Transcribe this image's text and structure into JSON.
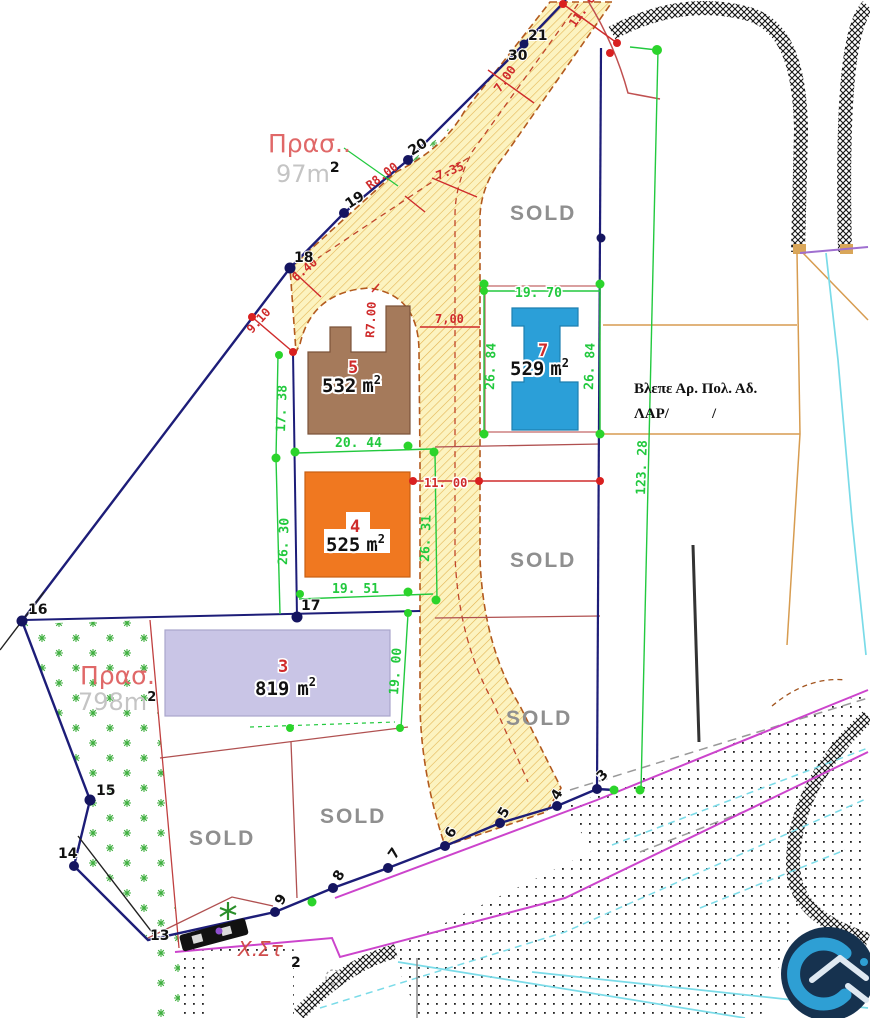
{
  "drawing": {
    "sold": "SOLD",
    "green_areas": [
      {
        "label": "Πρασ..",
        "area": "97m",
        "sup": "2"
      },
      {
        "label": "Πρασ.",
        "area": "798m",
        "sup": "2"
      }
    ],
    "plots": [
      {
        "number": "5",
        "area": "532",
        "unit": "m",
        "sup": "2"
      },
      {
        "number": "7",
        "area": "529",
        "unit": "m",
        "sup": "2"
      },
      {
        "number": "4",
        "area": "525",
        "unit": "m",
        "sup": "2"
      },
      {
        "number": "3",
        "area": "819",
        "unit": "m",
        "sup": "2"
      }
    ],
    "note": {
      "line1": "Βλεπε Αρ. Πολ. Αδ.",
      "line2": "ΛΑΡ/",
      "line2_end": "/"
    },
    "station": {
      "label": "Χ.Στ",
      "point": "2"
    },
    "dimensions": {
      "top_width": "11. 00",
      "road_width_top": "7.00",
      "road_width_upper": "7.35",
      "radius_top": "R8.00",
      "radius_plot5": "R7.00",
      "road_width_7": "7,00",
      "spur_width": "6.40",
      "offset_18": "9.10",
      "west_upper": "17. 38",
      "west_lower": "26. 30",
      "plot5_bottom": "20. 44",
      "plot4_bottom": "19. 51",
      "road_center": "26. 31",
      "road_width_mid": "11. 00",
      "plot7_top": "19. 70",
      "plot7_left": "26. 84",
      "plot7_right": "26. 84",
      "plot3_right": "19. 00",
      "east_length": "123. 28"
    },
    "points": {
      "p2": "2",
      "p3": "3",
      "p4": "4",
      "p5": "5",
      "p6": "6",
      "p7": "7",
      "p8": "8",
      "p9": "9",
      "p13": "13",
      "p14": "14",
      "p15": "15",
      "p16": "16",
      "p17": "17",
      "p18": "18",
      "p19": "19",
      "p20": "20",
      "p21": "21",
      "p21b": "30"
    },
    "colors": {
      "road_fill": "#fcf3c0",
      "road_hatch": "#e3b452",
      "road_edge": "#b35a1e",
      "boundary": "#1d1d78",
      "dimension_green": "#22c93e",
      "dimension_red": "#cf2b2b",
      "plot5": "#a57a5b",
      "plot7": "#2b9fd8",
      "plot4": "#f07820",
      "plot3": "#c9c5e6",
      "sold_text": "#8f8f8f",
      "magenta": "#cc44cc",
      "cyan": "#7adbe8",
      "vegetation": "#3faf3f",
      "logo_bg": "#16324f",
      "logo_mark": "#2e9fd4"
    }
  }
}
